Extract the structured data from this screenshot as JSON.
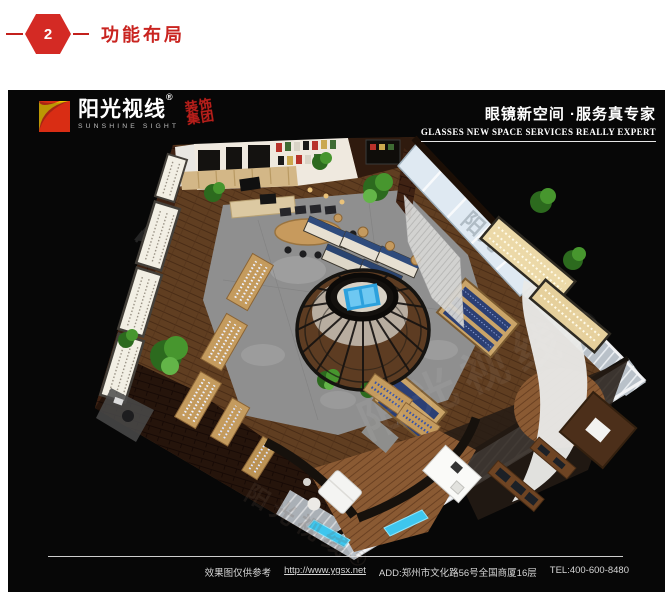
{
  "header": {
    "step_number": "2",
    "title": "功能布局"
  },
  "brand": {
    "logo_cn": "阳光视线",
    "logo_reg": "®",
    "logo_en": "SUNSHINE SIGHT",
    "badge_line1": "装饰",
    "badge_line2": "集团"
  },
  "tagline": {
    "cn": "眼镜新空间 ·服务真专家",
    "en": "GLASSES NEW SPACE SERVICES REALLY EXPERT"
  },
  "footer": {
    "disclaimer": "效果图仅供参考",
    "url": "http://www.ygsx.net",
    "address": "ADD:郑州市文化路56号全国商厦16层",
    "tel": "TEL:400-600-8480"
  },
  "watermark": {
    "glass": "阳光",
    "diagonal": "阳光视线®"
  },
  "colors": {
    "accent_red": "#c92420",
    "logo_red": "#e0301e",
    "logo_yellow": "#ffd400",
    "glow_blue": "#3ec6ee",
    "wood": "#6e4726",
    "brick": "#3f2213",
    "concrete": "#8f8f8f",
    "shelf_cream": "#ecd9a8",
    "product_blue": "#2b3f74"
  }
}
